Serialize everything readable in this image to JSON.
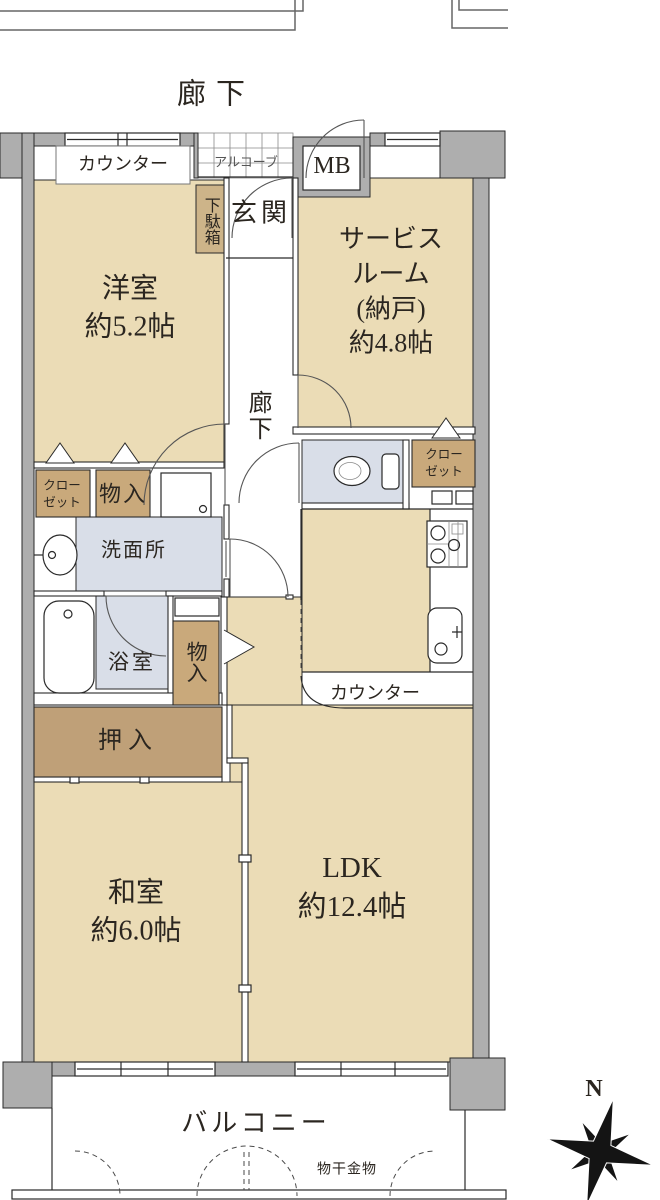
{
  "title": "マンション間取り図",
  "colors": {
    "room": "#EBDCB6",
    "closet": "#C9A97B",
    "oshiire": "#BFA078",
    "getabako": "#CDB489",
    "wet": "#D9DEE8",
    "wall": "#AEAEAE",
    "line": "#2A2A2A",
    "door": "#555555"
  },
  "common_areas": {
    "corridor_top": "廊下",
    "alcove": "アルコーブ",
    "meter_box": "MB",
    "balcony": "バルコニー",
    "laundry_hardware": "物干金物"
  },
  "unit": {
    "entrance": {
      "genkan": "玄関",
      "shoe_cabinet": "下駄箱",
      "counter": "カウンター"
    },
    "hallway": "廊下",
    "rooms": [
      {
        "id": "western",
        "name": "洋室",
        "size": "約5.2帖",
        "label": "洋室\n約5.2帖"
      },
      {
        "id": "service",
        "name": "サービスルーム(納戸)",
        "size": "約4.8帖",
        "label": "サービス\nルーム\n(納戸)\n約4.8帖"
      },
      {
        "id": "japanese",
        "name": "和室",
        "size": "約6.0帖",
        "label": "和室\n約6.0帖"
      },
      {
        "id": "ldk",
        "name": "LDK",
        "size": "約12.4帖",
        "label": "LDK\n約12.4帖"
      }
    ],
    "storage": {
      "closet_left": "クロー\nゼット",
      "closet_right": "クロー\nゼット",
      "monoire_left": "物入",
      "monoire_middle": "物入",
      "oshiire": "押入"
    },
    "wet_areas": {
      "washroom": "洗面所",
      "bathroom": "浴室"
    },
    "kitchen": {
      "counter": "カウンター"
    }
  },
  "compass": {
    "north_label": "N"
  }
}
